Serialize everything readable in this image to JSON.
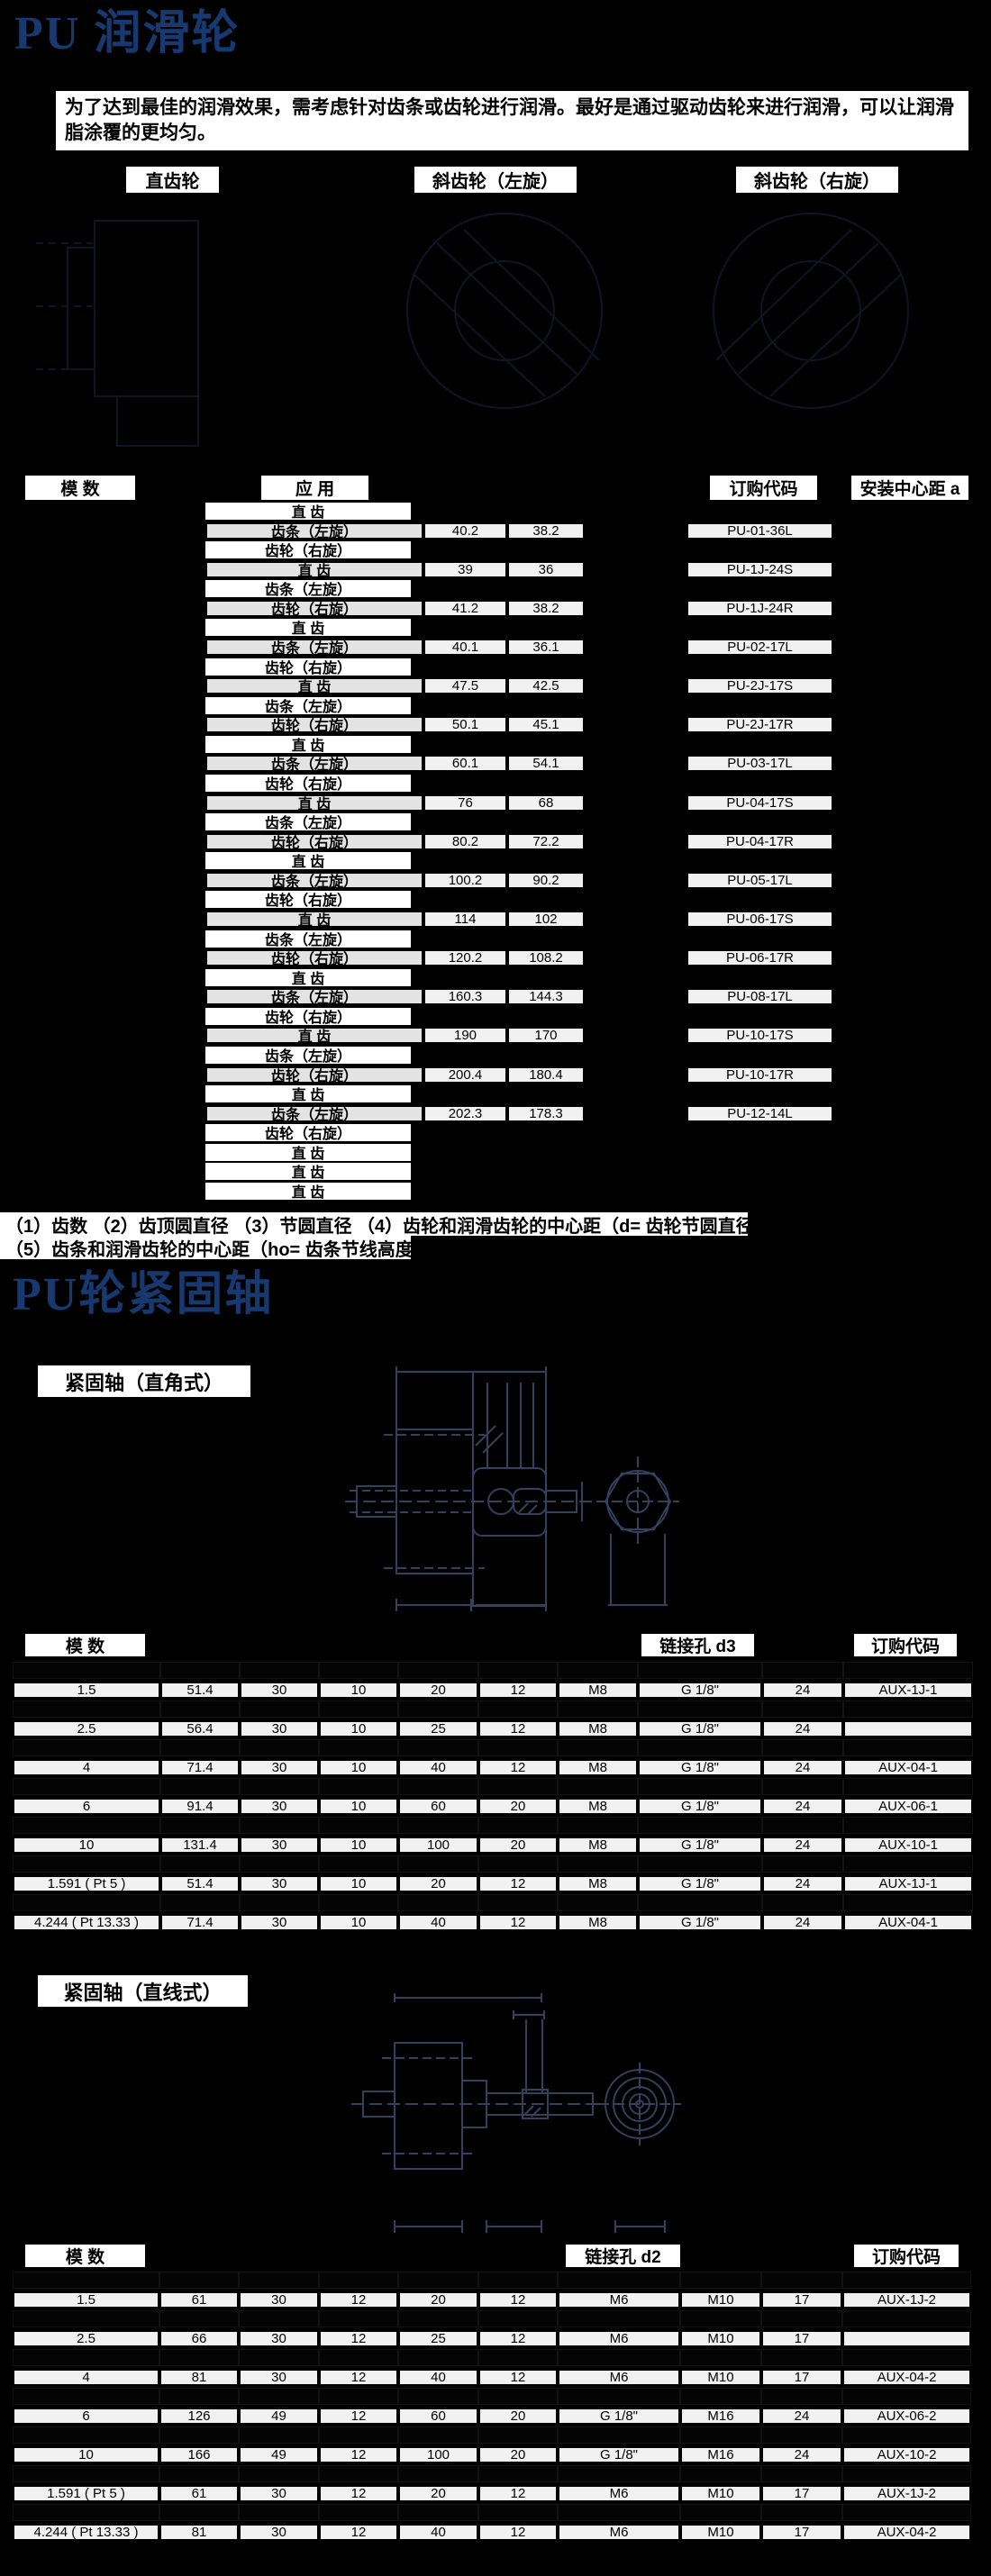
{
  "colors": {
    "page_bg": "#000000",
    "title_blue": "#17396f",
    "cell_light": "#f1f1f1",
    "cell_app_light": "#e3e3e3",
    "box_white": "#ffffff",
    "drawing_stroke": "#33415e"
  },
  "header": {
    "title": "PU 润滑轮"
  },
  "intro": {
    "text": "为了达到最佳的润滑效果，需考虑针对齿条或齿轮进行润滑。最好是通过驱动齿轮来进行润滑，可以让润滑脂涂覆的更均匀。"
  },
  "gear_type_labels": [
    {
      "label": "直齿轮"
    },
    {
      "label": "斜齿轮（左旋）"
    },
    {
      "label": "斜齿轮（右旋）"
    }
  ],
  "lubrication_table": {
    "headers": {
      "module": "模 数",
      "application": "应 用",
      "order_code": "订购代码",
      "mount_center_distance": "安装中心距 a"
    },
    "rows": [
      {
        "application": "直 齿",
        "tip_dia": "",
        "pitch_dia": "",
        "order_code": "",
        "highlight": false
      },
      {
        "application": "齿条（左旋）",
        "tip_dia": "40.2",
        "pitch_dia": "38.2",
        "order_code": "PU-01-36L",
        "highlight": true
      },
      {
        "application": "齿轮（右旋）",
        "tip_dia": "",
        "pitch_dia": "",
        "order_code": "",
        "highlight": false
      },
      {
        "application": "直 齿",
        "tip_dia": "39",
        "pitch_dia": "36",
        "order_code": "PU-1J-24S",
        "highlight": true
      },
      {
        "application": "齿条（左旋）",
        "tip_dia": "",
        "pitch_dia": "",
        "order_code": "",
        "highlight": false
      },
      {
        "application": "齿轮（右旋）",
        "tip_dia": "41.2",
        "pitch_dia": "38.2",
        "order_code": "PU-1J-24R",
        "highlight": true
      },
      {
        "application": "直 齿",
        "tip_dia": "",
        "pitch_dia": "",
        "order_code": "",
        "highlight": false
      },
      {
        "application": "齿条（左旋）",
        "tip_dia": "40.1",
        "pitch_dia": "36.1",
        "order_code": "PU-02-17L",
        "highlight": true
      },
      {
        "application": "齿轮（右旋）",
        "tip_dia": "",
        "pitch_dia": "",
        "order_code": "",
        "highlight": false
      },
      {
        "application": "直 齿",
        "tip_dia": "47.5",
        "pitch_dia": "42.5",
        "order_code": "PU-2J-17S",
        "highlight": true
      },
      {
        "application": "齿条（左旋）",
        "tip_dia": "",
        "pitch_dia": "",
        "order_code": "",
        "highlight": false
      },
      {
        "application": "齿轮（右旋）",
        "tip_dia": "50.1",
        "pitch_dia": "45.1",
        "order_code": "PU-2J-17R",
        "highlight": true
      },
      {
        "application": "直 齿",
        "tip_dia": "",
        "pitch_dia": "",
        "order_code": "",
        "highlight": false
      },
      {
        "application": "齿条（左旋）",
        "tip_dia": "60.1",
        "pitch_dia": "54.1",
        "order_code": "PU-03-17L",
        "highlight": true
      },
      {
        "application": "齿轮（右旋）",
        "tip_dia": "",
        "pitch_dia": "",
        "order_code": "",
        "highlight": false
      },
      {
        "application": "直 齿",
        "tip_dia": "76",
        "pitch_dia": "68",
        "order_code": "PU-04-17S",
        "highlight": true
      },
      {
        "application": "齿条（左旋）",
        "tip_dia": "",
        "pitch_dia": "",
        "order_code": "",
        "highlight": false
      },
      {
        "application": "齿轮（右旋）",
        "tip_dia": "80.2",
        "pitch_dia": "72.2",
        "order_code": "PU-04-17R",
        "highlight": true
      },
      {
        "application": "直 齿",
        "tip_dia": "",
        "pitch_dia": "",
        "order_code": "",
        "highlight": false
      },
      {
        "application": "齿条（左旋）",
        "tip_dia": "100.2",
        "pitch_dia": "90.2",
        "order_code": "PU-05-17L",
        "highlight": true
      },
      {
        "application": "齿轮（右旋）",
        "tip_dia": "",
        "pitch_dia": "",
        "order_code": "",
        "highlight": false
      },
      {
        "application": "直 齿",
        "tip_dia": "114",
        "pitch_dia": "102",
        "order_code": "PU-06-17S",
        "highlight": true
      },
      {
        "application": "齿条（左旋）",
        "tip_dia": "",
        "pitch_dia": "",
        "order_code": "",
        "highlight": false
      },
      {
        "application": "齿轮（右旋）",
        "tip_dia": "120.2",
        "pitch_dia": "108.2",
        "order_code": "PU-06-17R",
        "highlight": true
      },
      {
        "application": "直 齿",
        "tip_dia": "",
        "pitch_dia": "",
        "order_code": "",
        "highlight": false
      },
      {
        "application": "齿条（左旋）",
        "tip_dia": "160.3",
        "pitch_dia": "144.3",
        "order_code": "PU-08-17L",
        "highlight": true
      },
      {
        "application": "齿轮（右旋）",
        "tip_dia": "",
        "pitch_dia": "",
        "order_code": "",
        "highlight": false
      },
      {
        "application": "直 齿",
        "tip_dia": "190",
        "pitch_dia": "170",
        "order_code": "PU-10-17S",
        "highlight": true
      },
      {
        "application": "齿条（左旋）",
        "tip_dia": "",
        "pitch_dia": "",
        "order_code": "",
        "highlight": false
      },
      {
        "application": "齿轮（右旋）",
        "tip_dia": "200.4",
        "pitch_dia": "180.4",
        "order_code": "PU-10-17R",
        "highlight": true
      },
      {
        "application": "直 齿",
        "tip_dia": "",
        "pitch_dia": "",
        "order_code": "",
        "highlight": false
      },
      {
        "application": "齿条（左旋）",
        "tip_dia": "202.3",
        "pitch_dia": "178.3",
        "order_code": "PU-12-14L",
        "highlight": true
      },
      {
        "application": "齿轮（右旋）",
        "tip_dia": "",
        "pitch_dia": "",
        "order_code": "",
        "highlight": false
      },
      {
        "application": "直 齿",
        "tip_dia": "",
        "pitch_dia": "",
        "order_code": "",
        "highlight": false
      },
      {
        "application": "直 齿",
        "tip_dia": "",
        "pitch_dia": "",
        "order_code": "",
        "highlight": false
      },
      {
        "application": "直 齿",
        "tip_dia": "",
        "pitch_dia": "",
        "order_code": "",
        "highlight": false
      }
    ]
  },
  "footnotes": [
    "（1）齿数 （2）齿顶圆直径 （3）节圆直径 （4）齿轮和润滑齿轮的中心距（d= 齿轮节圆直径）",
    "（5）齿条和润滑齿轮的中心距（ho= 齿条节线高度）"
  ],
  "section2": {
    "title": "PU轮紧固轴",
    "label_right_angle": "紧固轴（直角式）",
    "label_straight": "紧固轴（直线式）"
  },
  "shaft_table_right_angle": {
    "headers": {
      "module": "模 数",
      "link_hole": "链接孔 d3",
      "order_code": "订购代码"
    },
    "rows": [
      {
        "cells": [
          "",
          "",
          "",
          "",
          "",
          "",
          "",
          "",
          "",
          ""
        ],
        "highlight": false
      },
      {
        "cells": [
          "1.5",
          "51.4",
          "30",
          "10",
          "20",
          "12",
          "M8",
          "G 1/8\"",
          "24",
          "AUX-1J-1"
        ],
        "highlight": true
      },
      {
        "cells": [
          "",
          "",
          "",
          "",
          "",
          "",
          "",
          "",
          "",
          ""
        ],
        "highlight": false
      },
      {
        "cells": [
          "2.5",
          "56.4",
          "30",
          "10",
          "25",
          "12",
          "M8",
          "G 1/8\"",
          "24",
          ""
        ],
        "highlight": true
      },
      {
        "cells": [
          "",
          "",
          "",
          "",
          "",
          "",
          "",
          "",
          "",
          ""
        ],
        "highlight": false
      },
      {
        "cells": [
          "4",
          "71.4",
          "30",
          "10",
          "40",
          "12",
          "M8",
          "G 1/8\"",
          "24",
          "AUX-04-1"
        ],
        "highlight": true
      },
      {
        "cells": [
          "",
          "",
          "",
          "",
          "",
          "",
          "",
          "",
          "",
          ""
        ],
        "highlight": false
      },
      {
        "cells": [
          "6",
          "91.4",
          "30",
          "10",
          "60",
          "20",
          "M8",
          "G 1/8\"",
          "24",
          "AUX-06-1"
        ],
        "highlight": true
      },
      {
        "cells": [
          "",
          "",
          "",
          "",
          "",
          "",
          "",
          "",
          "",
          ""
        ],
        "highlight": false
      },
      {
        "cells": [
          "10",
          "131.4",
          "30",
          "10",
          "100",
          "20",
          "M8",
          "G 1/8\"",
          "24",
          "AUX-10-1"
        ],
        "highlight": true
      },
      {
        "cells": [
          "",
          "",
          "",
          "",
          "",
          "",
          "",
          "",
          "",
          ""
        ],
        "highlight": false
      },
      {
        "cells": [
          "1.591 ( Pt 5 )",
          "51.4",
          "30",
          "10",
          "20",
          "12",
          "M8",
          "G 1/8\"",
          "24",
          "AUX-1J-1"
        ],
        "highlight": true
      },
      {
        "cells": [
          "",
          "",
          "",
          "",
          "",
          "",
          "",
          "",
          "",
          ""
        ],
        "highlight": false
      },
      {
        "cells": [
          "4.244 ( Pt 13.33 )",
          "71.4",
          "30",
          "10",
          "40",
          "12",
          "M8",
          "G 1/8\"",
          "24",
          "AUX-04-1"
        ],
        "highlight": true
      }
    ]
  },
  "shaft_table_straight": {
    "headers": {
      "module": "模 数",
      "link_hole": "链接孔 d2",
      "order_code": "订购代码"
    },
    "rows": [
      {
        "cells": [
          "",
          "",
          "",
          "",
          "",
          "",
          "",
          "",
          "",
          ""
        ],
        "highlight": false
      },
      {
        "cells": [
          "1.5",
          "61",
          "30",
          "12",
          "20",
          "12",
          "M6",
          "M10",
          "17",
          "AUX-1J-2"
        ],
        "highlight": true
      },
      {
        "cells": [
          "",
          "",
          "",
          "",
          "",
          "",
          "",
          "",
          "",
          ""
        ],
        "highlight": false
      },
      {
        "cells": [
          "2.5",
          "66",
          "30",
          "12",
          "25",
          "12",
          "M6",
          "M10",
          "17",
          ""
        ],
        "highlight": true
      },
      {
        "cells": [
          "",
          "",
          "",
          "",
          "",
          "",
          "",
          "",
          "",
          ""
        ],
        "highlight": false
      },
      {
        "cells": [
          "4",
          "81",
          "30",
          "12",
          "40",
          "12",
          "M6",
          "M10",
          "17",
          "AUX-04-2"
        ],
        "highlight": true
      },
      {
        "cells": [
          "",
          "",
          "",
          "",
          "",
          "",
          "",
          "",
          "",
          ""
        ],
        "highlight": false
      },
      {
        "cells": [
          "6",
          "126",
          "49",
          "12",
          "60",
          "20",
          "G 1/8\"",
          "M16",
          "24",
          "AUX-06-2"
        ],
        "highlight": true
      },
      {
        "cells": [
          "",
          "",
          "",
          "",
          "",
          "",
          "",
          "",
          "",
          ""
        ],
        "highlight": false
      },
      {
        "cells": [
          "10",
          "166",
          "49",
          "12",
          "100",
          "20",
          "G 1/8\"",
          "M16",
          "24",
          "AUX-10-2"
        ],
        "highlight": true
      },
      {
        "cells": [
          "",
          "",
          "",
          "",
          "",
          "",
          "",
          "",
          "",
          ""
        ],
        "highlight": false
      },
      {
        "cells": [
          "1.591 ( Pt 5 )",
          "61",
          "30",
          "12",
          "20",
          "12",
          "M6",
          "M10",
          "17",
          "AUX-1J-2"
        ],
        "highlight": true
      },
      {
        "cells": [
          "",
          "",
          "",
          "",
          "",
          "",
          "",
          "",
          "",
          ""
        ],
        "highlight": false
      },
      {
        "cells": [
          "4.244 ( Pt 13.33 )",
          "81",
          "30",
          "12",
          "40",
          "12",
          "M6",
          "M10",
          "17",
          "AUX-04-2"
        ],
        "highlight": true
      }
    ]
  }
}
